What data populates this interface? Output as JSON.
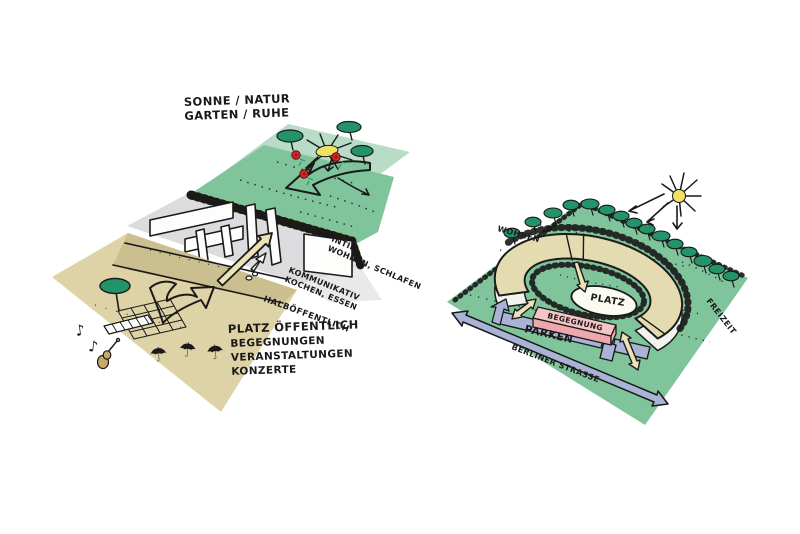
{
  "diagram_type": "hand-drawn architectural concept sketches",
  "left_diagram": {
    "garden_label": [
      "SONNE / NATUR",
      "GARTEN / RUHE"
    ],
    "intim_label": [
      "INTIM",
      "WOHNEN, SCHLAFEN"
    ],
    "kommunikativ_label": [
      "KOMMUNIKATIV",
      "KOCHEN, ESSEN"
    ],
    "halboeffentlich_label": "HALBÖFFENTLICH",
    "platz_label": [
      "PLATZ ÖFFENTLICH",
      "BEGEGNUNGEN",
      "VERANSTALTUNGEN",
      "KONZERTE"
    ]
  },
  "right_diagram": {
    "wohnen_label": "WOHNEN",
    "platz_label": "PLATZ",
    "begegnung_label": "BEGEGNUNG",
    "parken_label": "PARKEN",
    "street_label": "BERLINER STRASSE",
    "freizeit_label": "FREIZEIT"
  },
  "icons": {
    "umbrella": "☂",
    "music_note": "♪"
  },
  "colors": {
    "ink": "#1a1a1a",
    "mint": "#b9dcc6",
    "green": "#7fc49b",
    "tree-green": "#23946a",
    "grey-plane": "#dcdcde",
    "grey-light": "#e9e9eb",
    "beige": "#ded3a6",
    "beige-dark": "#cbbf90",
    "wall-white": "#fdfdfc",
    "hatch-yellow": "#e3c93f",
    "flower-red": "#d62828",
    "sun-yellow": "#f2e264",
    "pink": "#f6c3c7",
    "pink-dark": "#eca8ae",
    "blue": "#a9b3d6",
    "arrow-beige": "#ece2b6",
    "ring-beige": "#e5dbb0",
    "ring-white": "#f2f2ef",
    "paper": "#fbfaf3"
  }
}
